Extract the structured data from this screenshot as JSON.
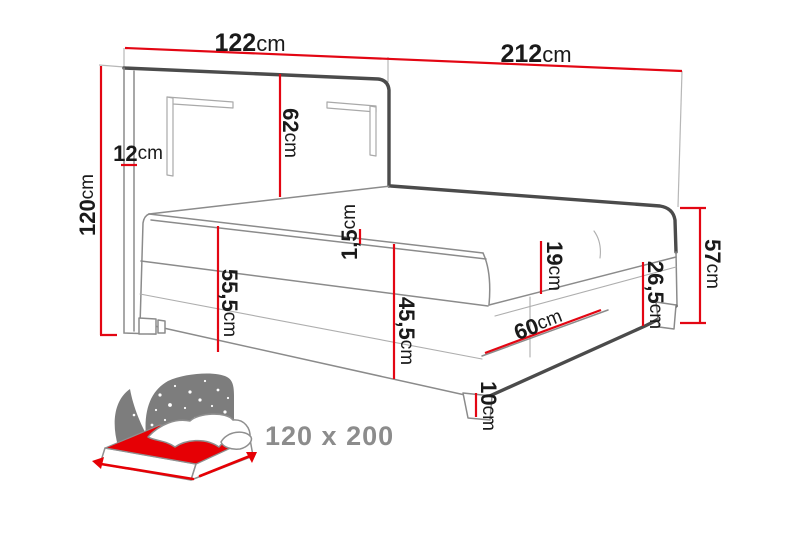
{
  "diagram": {
    "labels": {
      "headboard_width": {
        "value": "122",
        "unit": "cm"
      },
      "total_length": {
        "value": "212",
        "unit": "cm"
      },
      "headboard_depth": {
        "value": "12",
        "unit": "cm"
      },
      "headboard_total_height": {
        "value": "120",
        "unit": "cm"
      },
      "headboard_above_mattress": {
        "value": "62",
        "unit": "cm"
      },
      "topper_thickness": {
        "value": "1,5",
        "unit": "cm"
      },
      "mattress_top_height": {
        "value": "55,5",
        "unit": "cm"
      },
      "base_top_height": {
        "value": "45,5",
        "unit": "cm"
      },
      "mattress_thickness": {
        "value": "19",
        "unit": "cm"
      },
      "base_thickness": {
        "value": "26,5",
        "unit": "cm"
      },
      "foot_total_height": {
        "value": "57",
        "unit": "cm"
      },
      "drawer_width": {
        "value": "60",
        "unit": "cm"
      },
      "leg_height": {
        "value": "10",
        "unit": "cm"
      }
    },
    "size_badge": "120 x 200",
    "colors": {
      "dimension_line": "#e30613",
      "outline_dark": "#4b4b4b",
      "outline_medium": "#8b8b8b",
      "icon_grey": "#7d7d7d",
      "icon_red": "#e60005",
      "size_text": "#8c8c8c",
      "label_text": "#1a1a1a",
      "background": "#ffffff"
    }
  }
}
